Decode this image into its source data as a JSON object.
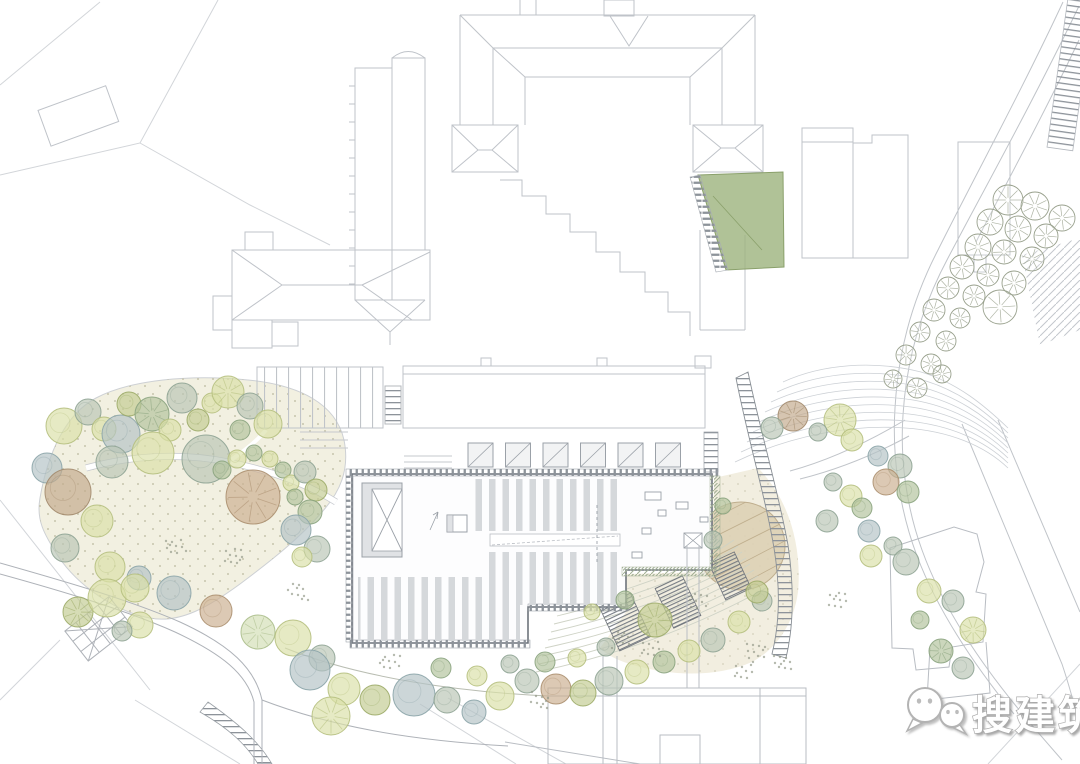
{
  "watermark": {
    "text": "搜建筑",
    "icon": "wechat-icon",
    "text_color": "#ffffff",
    "outline_color": "#a9a9a9"
  },
  "palette": {
    "line_light": "#c5c9ce",
    "line_faint": "#d9dbde",
    "line_dark": "#6d737b",
    "hatch_dark": "#8d939a",
    "stripe": "#d5d8db",
    "building_fill": "#fdfdfe",
    "lawn": "#f2f0e1",
    "lawn_dot": "#c2c0a6",
    "plaza": "#f0ebdb",
    "deck": "#ddd0b5",
    "deck_line": "#bfae8e",
    "green_building": "#9cb37d",
    "shrub_hatch": "#9fae92",
    "tree_colors": {
      "sg": {
        "fill": "#b9c6b6",
        "stroke": "#8ea394"
      },
      "yg": {
        "fill": "#dae0a8",
        "stroke": "#b5bf7e"
      },
      "ol": {
        "fill": "#c3cb92",
        "stroke": "#9cab68"
      },
      "bg": {
        "fill": "#b4c3c6",
        "stroke": "#8ba4a8"
      },
      "tn": {
        "fill": "#ccb090",
        "stroke": "#ab8f6f"
      },
      "gn": {
        "fill": "#b2c29c",
        "stroke": "#8aa37e"
      },
      "lg": {
        "fill": "#d3deb6",
        "stroke": "#aabd8a"
      },
      "br": {
        "fill": "#c2a98c",
        "stroke": "#a28a6d"
      }
    }
  },
  "trees": [
    [
      64,
      426,
      18,
      "yg",
      0
    ],
    [
      88,
      412,
      13,
      "sg",
      0
    ],
    [
      104,
      429,
      12,
      "yg",
      0
    ],
    [
      121,
      434,
      19,
      "bg",
      0
    ],
    [
      129,
      404,
      12,
      "ol",
      0
    ],
    [
      152,
      414,
      17,
      "gn",
      1
    ],
    [
      170,
      430,
      11,
      "yg",
      0
    ],
    [
      182,
      398,
      15,
      "sg",
      0
    ],
    [
      198,
      420,
      11,
      "ol",
      0
    ],
    [
      212,
      403,
      10,
      "yg",
      0
    ],
    [
      228,
      392,
      16,
      "yg",
      1
    ],
    [
      250,
      406,
      13,
      "sg",
      0
    ],
    [
      268,
      424,
      14,
      "yg",
      0
    ],
    [
      240,
      430,
      10,
      "gn",
      0
    ],
    [
      153,
      453,
      21,
      "yg",
      0
    ],
    [
      206,
      459,
      24,
      "sg",
      0
    ],
    [
      112,
      462,
      16,
      "sg",
      0
    ],
    [
      47,
      468,
      15,
      "bg",
      0
    ],
    [
      68,
      492,
      23,
      "br",
      0
    ],
    [
      97,
      521,
      16,
      "yg",
      0
    ],
    [
      65,
      548,
      14,
      "sg",
      0
    ],
    [
      110,
      567,
      15,
      "yg",
      0
    ],
    [
      139,
      578,
      12,
      "bg",
      0
    ],
    [
      253,
      497,
      27,
      "tn",
      1
    ],
    [
      222,
      470,
      9,
      "gn",
      0
    ],
    [
      237,
      459,
      9,
      "yg",
      0
    ],
    [
      254,
      453,
      8,
      "gn",
      0
    ],
    [
      270,
      459,
      8,
      "yg",
      0
    ],
    [
      283,
      470,
      8,
      "gn",
      0
    ],
    [
      291,
      483,
      8,
      "yg",
      0
    ],
    [
      295,
      497,
      8,
      "gn",
      0
    ],
    [
      305,
      472,
      11,
      "sg",
      0
    ],
    [
      316,
      490,
      11,
      "ol",
      0
    ],
    [
      310,
      512,
      12,
      "gn",
      0
    ],
    [
      296,
      530,
      15,
      "bg",
      0
    ],
    [
      317,
      549,
      13,
      "sg",
      0
    ],
    [
      302,
      557,
      10,
      "yg",
      0
    ],
    [
      78,
      612,
      15,
      "ol",
      1
    ],
    [
      107,
      598,
      19,
      "yg",
      0
    ],
    [
      140,
      625,
      13,
      "yg",
      0
    ],
    [
      122,
      631,
      10,
      "sg",
      0
    ],
    [
      135,
      588,
      14,
      "yg",
      0
    ],
    [
      174,
      593,
      17,
      "bg",
      0
    ],
    [
      216,
      611,
      16,
      "tn",
      0
    ],
    [
      258,
      632,
      17,
      "lg",
      1
    ],
    [
      293,
      638,
      18,
      "yg",
      0
    ],
    [
      322,
      658,
      13,
      "sg",
      0
    ],
    [
      310,
      670,
      20,
      "bg",
      0
    ],
    [
      344,
      689,
      16,
      "yg",
      0
    ],
    [
      375,
      700,
      15,
      "ol",
      0
    ],
    [
      331,
      716,
      19,
      "yg",
      1
    ],
    [
      414,
      695,
      21,
      "bg",
      0
    ],
    [
      447,
      700,
      13,
      "sg",
      0
    ],
    [
      474,
      712,
      12,
      "bg",
      0
    ],
    [
      500,
      696,
      14,
      "yg",
      0
    ],
    [
      527,
      681,
      12,
      "sg",
      0
    ],
    [
      556,
      689,
      15,
      "tn",
      0
    ],
    [
      583,
      693,
      13,
      "ol",
      0
    ],
    [
      609,
      681,
      14,
      "sg",
      0
    ],
    [
      637,
      672,
      12,
      "yg",
      0
    ],
    [
      664,
      662,
      11,
      "gn",
      0
    ],
    [
      689,
      651,
      11,
      "yg",
      0
    ],
    [
      713,
      640,
      12,
      "sg",
      0
    ],
    [
      739,
      622,
      11,
      "yg",
      0
    ],
    [
      762,
      601,
      10,
      "sg",
      0
    ],
    [
      441,
      668,
      10,
      "gn",
      0
    ],
    [
      477,
      676,
      10,
      "yg",
      0
    ],
    [
      510,
      664,
      9,
      "sg",
      0
    ],
    [
      545,
      662,
      10,
      "gn",
      0
    ],
    [
      577,
      658,
      9,
      "yg",
      0
    ],
    [
      606,
      647,
      9,
      "sg",
      0
    ],
    [
      655,
      620,
      17,
      "ol",
      1
    ],
    [
      625,
      600,
      9,
      "gn",
      0
    ],
    [
      592,
      612,
      8,
      "yg",
      0
    ],
    [
      793,
      416,
      15,
      "br",
      1
    ],
    [
      772,
      428,
      11,
      "sg",
      0
    ],
    [
      840,
      420,
      16,
      "yg",
      1
    ],
    [
      852,
      440,
      11,
      "yg",
      0
    ],
    [
      818,
      432,
      9,
      "sg",
      0
    ],
    [
      878,
      456,
      10,
      "bg",
      0
    ],
    [
      900,
      466,
      12,
      "sg",
      0
    ],
    [
      886,
      482,
      13,
      "tn",
      0
    ],
    [
      908,
      492,
      11,
      "gn",
      0
    ],
    [
      851,
      496,
      11,
      "yg",
      0
    ],
    [
      833,
      482,
      9,
      "sg",
      0
    ],
    [
      862,
      508,
      10,
      "gn",
      0
    ],
    [
      827,
      521,
      11,
      "sg",
      0
    ],
    [
      869,
      531,
      11,
      "bg",
      0
    ],
    [
      893,
      546,
      9,
      "sg",
      0
    ],
    [
      871,
      556,
      11,
      "yg",
      0
    ],
    [
      906,
      562,
      13,
      "sg",
      0
    ],
    [
      929,
      591,
      12,
      "yg",
      0
    ],
    [
      953,
      601,
      11,
      "sg",
      0
    ],
    [
      973,
      630,
      13,
      "yg",
      1
    ],
    [
      941,
      651,
      12,
      "gn",
      1
    ],
    [
      963,
      668,
      11,
      "sg",
      0
    ],
    [
      920,
      620,
      9,
      "gn",
      0
    ],
    [
      713,
      540,
      9,
      "sg",
      0
    ],
    [
      757,
      592,
      11,
      "ol",
      0
    ],
    [
      723,
      506,
      8,
      "gn",
      0
    ]
  ],
  "line_trees": [
    [
      1008,
      200,
      15
    ],
    [
      1035,
      206,
      14
    ],
    [
      1062,
      218,
      13
    ],
    [
      990,
      222,
      13
    ],
    [
      1018,
      229,
      13
    ],
    [
      1046,
      236,
      12
    ],
    [
      978,
      247,
      13
    ],
    [
      1004,
      252,
      12
    ],
    [
      1032,
      259,
      12
    ],
    [
      962,
      267,
      12
    ],
    [
      988,
      275,
      11
    ],
    [
      1014,
      283,
      12
    ],
    [
      948,
      288,
      11
    ],
    [
      974,
      296,
      11
    ],
    [
      1000,
      307,
      17
    ],
    [
      934,
      310,
      11
    ],
    [
      960,
      318,
      10
    ],
    [
      920,
      332,
      10
    ],
    [
      946,
      341,
      10
    ],
    [
      906,
      355,
      10
    ],
    [
      931,
      364,
      10
    ],
    [
      893,
      379,
      9
    ],
    [
      917,
      388,
      10
    ],
    [
      942,
      374,
      9
    ]
  ],
  "dot_clusters": [
    [
      757,
      652
    ],
    [
      783,
      662
    ],
    [
      744,
      670
    ],
    [
      620,
      640
    ],
    [
      650,
      650
    ],
    [
      836,
      600
    ],
    [
      390,
      660
    ],
    [
      298,
      592
    ],
    [
      176,
      548
    ],
    [
      235,
      556
    ],
    [
      700,
      600
    ],
    [
      540,
      700
    ]
  ]
}
